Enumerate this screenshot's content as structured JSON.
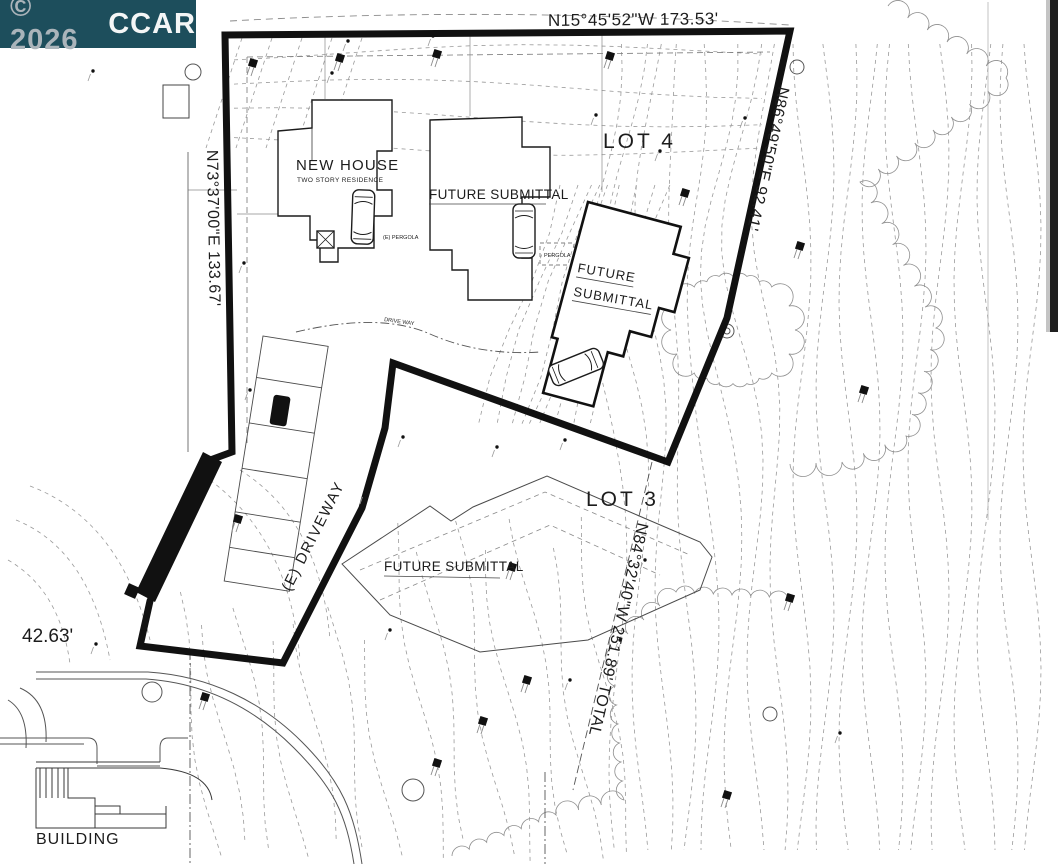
{
  "watermark": {
    "copyright": "© 2026",
    "brand": "CCAR",
    "bg_color": "#1d4e5c",
    "copyright_color": "#aab4ba",
    "brand_color": "#f4f6f6"
  },
  "plan": {
    "lots": {
      "lot4": "LOT 4",
      "lot3": "LOT 3"
    },
    "bearings": {
      "top": "N15°45'52\"W  173.53'",
      "right": "N86°49'50\"E 92.41'",
      "left": "N73°37'00\"E  133.67'",
      "lot3_line": "N84°32'40\"W  251.89' TOTAL"
    },
    "buildings": {
      "new_house": "NEW HOUSE",
      "new_house_sub": "TWO STORY RESIDENCE",
      "future_mid": "FUTURE SUBMITTAL",
      "future_lot4_line1": "FUTURE",
      "future_lot4_line2": "SUBMITTAL",
      "future_lot3": "FUTURE SUBMITTAL",
      "neighbor": "BUILDING"
    },
    "labels": {
      "driveway": "(E) DRIVEWAY",
      "drive_way_path": "DRIVE WAY",
      "pergola_left": "(E) PERGOLA",
      "pergola_right": "PERGOLA",
      "dim_left": "42.63'"
    }
  },
  "colors": {
    "boundary": "#111111",
    "line": "#2a2a2a",
    "contour": "#9a9a9a",
    "paper": "#ffffff"
  }
}
